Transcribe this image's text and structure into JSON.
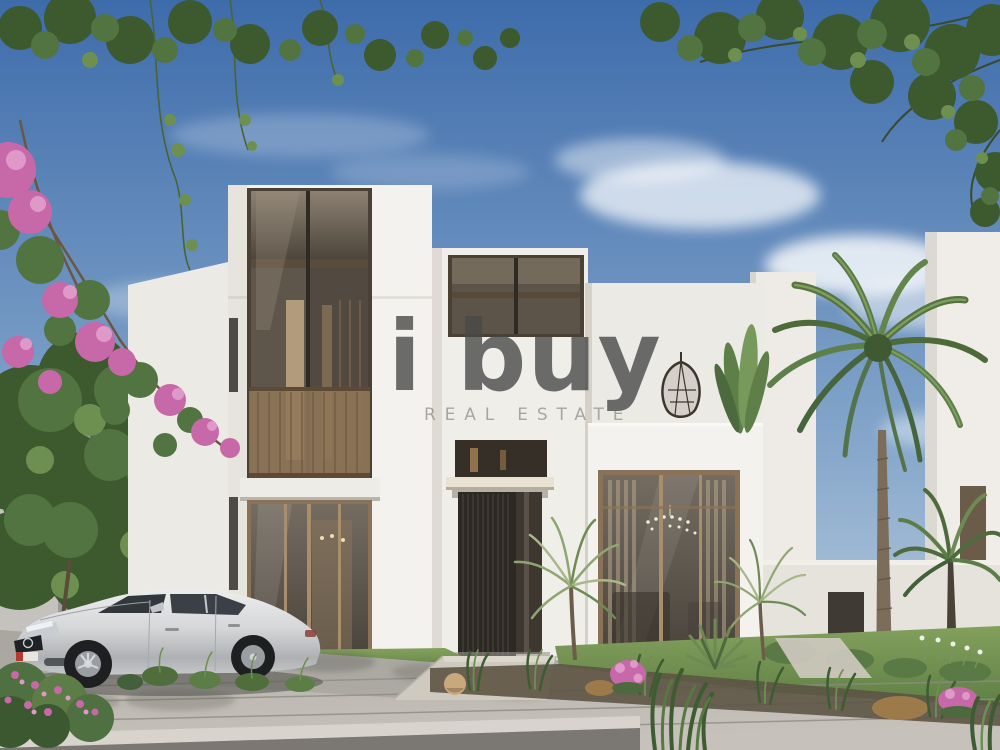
{
  "image": {
    "kind": "real-estate architectural rendering photo",
    "subject": "Modern two-storey white villa with bronze-framed glazing, landscaped front yard, date palm, and a silver sedan parked on the street under a blue sky",
    "objects": [
      "white villa facade",
      "bronze glass curtain wall",
      "balcony railing",
      "slatted entrance door with canopy",
      "roof terrace with hanging chair and potted plant",
      "living room window with chandelier",
      "date palm tree",
      "fan palms",
      "bougainvillea with pink flowers",
      "overhanging tree branches",
      "silver sedan",
      "paved street with curb",
      "entrance walkway",
      "lawn and planting bed with grasses, rocks and pink flowers",
      "neighbouring white villas"
    ]
  },
  "watermark": {
    "logo_text": "i buy",
    "subtitle": "REAL ESTATE"
  },
  "palette": {
    "sky_top": "#3e6cab",
    "sky_mid": "#7fa2c8",
    "sky_low": "#c8d7e3",
    "cloud": "#ffffff",
    "wall_lit": "#f4f2ee",
    "wall_soft": "#eceae4",
    "wall_shade": "#dcd8d1",
    "wall_dark": "#c7c3bd",
    "bronze": "#8a7258",
    "bronze_dark": "#4a4034",
    "glass_hi": "#8c8172",
    "glass_lo": "#4e463c",
    "door": "#2c2824",
    "slat": "#4d463c",
    "foliage_dark": "#3c5a2e",
    "foliage_mid": "#527440",
    "foliage_light": "#6d9050",
    "palm_core": "#3f5a33",
    "trunk": "#7b6d5a",
    "pink": "#c768a8",
    "pink_light": "#de99c8",
    "lawn_hi": "#83a05c",
    "lawn_lo": "#5f7f45",
    "road_hi": "#c6c2bb",
    "road_lo": "#b3afa8",
    "road_line": "#8f8b85",
    "curb": "#d8d4cd",
    "curb_shadow": "#7b7873",
    "path": "#cfcac0",
    "soil": "#5d5444",
    "rock": "#c9a97c",
    "dry_grass": "#9c7a4a",
    "interior_warm": "#c7ad86",
    "car_hi": "#eceded",
    "car_lo": "#aeb0b3",
    "car_glass": "#32373c",
    "car_dark": "#1f2225",
    "plate_red": "#b23a30",
    "wm_logo": "rgba(72,72,72,0.8)",
    "wm_sub": "rgba(108,108,108,0.55)"
  }
}
